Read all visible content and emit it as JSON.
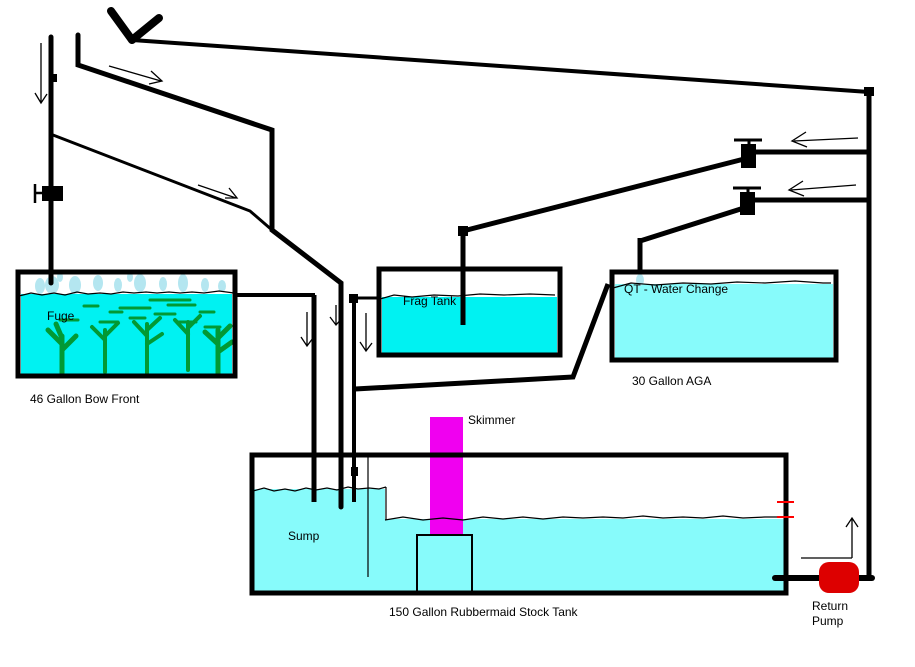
{
  "colors": {
    "background": "#ffffff",
    "line": "#000000",
    "water_bright": "#00f2f2",
    "water_pale": "#87fbfb",
    "splash": "#b4e6f0",
    "algae": "#029934",
    "skimmer": "#f000f0",
    "pump": "#dd0000",
    "level_mark": "#ff0000"
  },
  "diagram": {
    "labels": {
      "fuge": "Fuge",
      "fuge_caption": "46 Gallon Bow Front",
      "frag_tank": "Frag Tank",
      "qt": "QT - Water Change",
      "qt_caption": "30 Gallon AGA",
      "skimmer": "Skimmer",
      "sump": "Sump",
      "stock_tank_caption": "150 Gallon Rubbermaid Stock Tank",
      "return_pump_line1": "Return",
      "return_pump_line2": "Pump"
    }
  }
}
